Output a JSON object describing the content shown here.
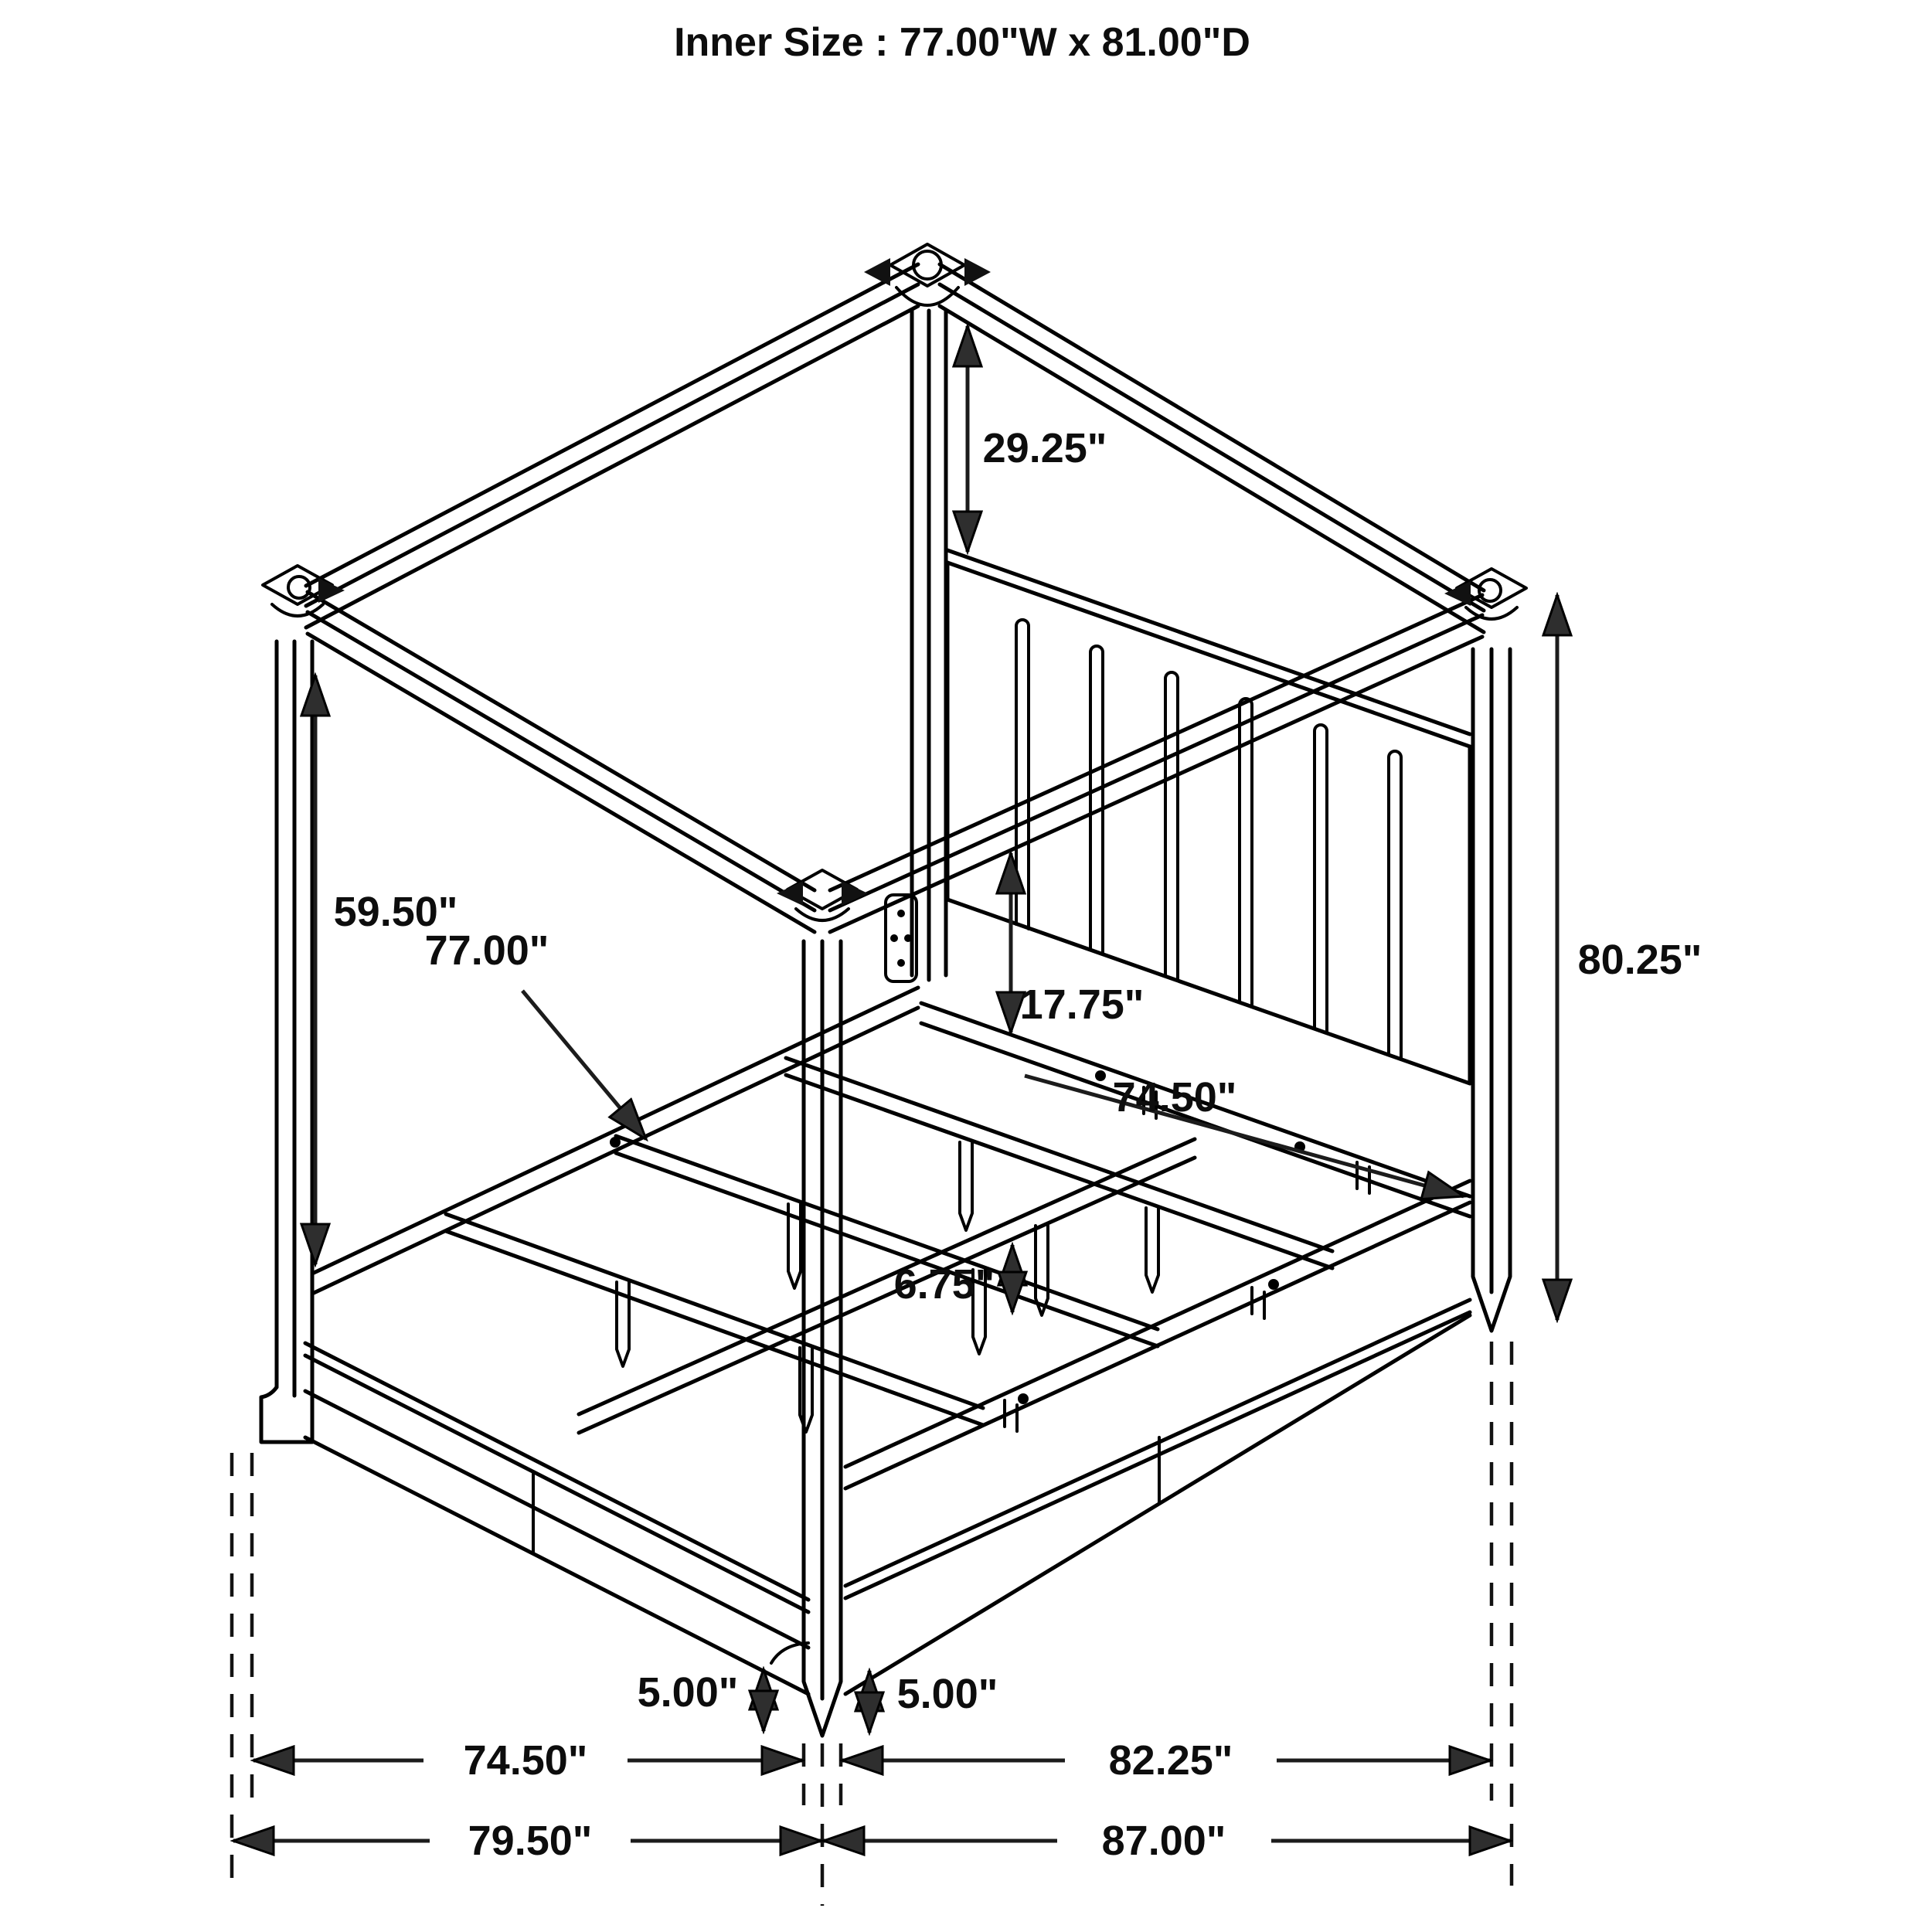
{
  "title": "Inner Size : 77.00\"W x 81.00\"D",
  "dims": {
    "canopy_drop": "29.25\"",
    "post_clearance": "59.50\"",
    "slat_length": "77.00\"",
    "canopy_to_headrail": "17.75\"",
    "rail_inner_depth": "74.50\"",
    "post_overall_height": "80.25\"",
    "support_leg_height": "6.75\"",
    "foot_height_front": "5.00\"",
    "foot_height_side": "5.00\"",
    "base_width_inner": "74.50\"",
    "base_depth_inner": "82.25\"",
    "base_width_overall": "79.50\"",
    "base_depth_overall": "87.00\""
  }
}
